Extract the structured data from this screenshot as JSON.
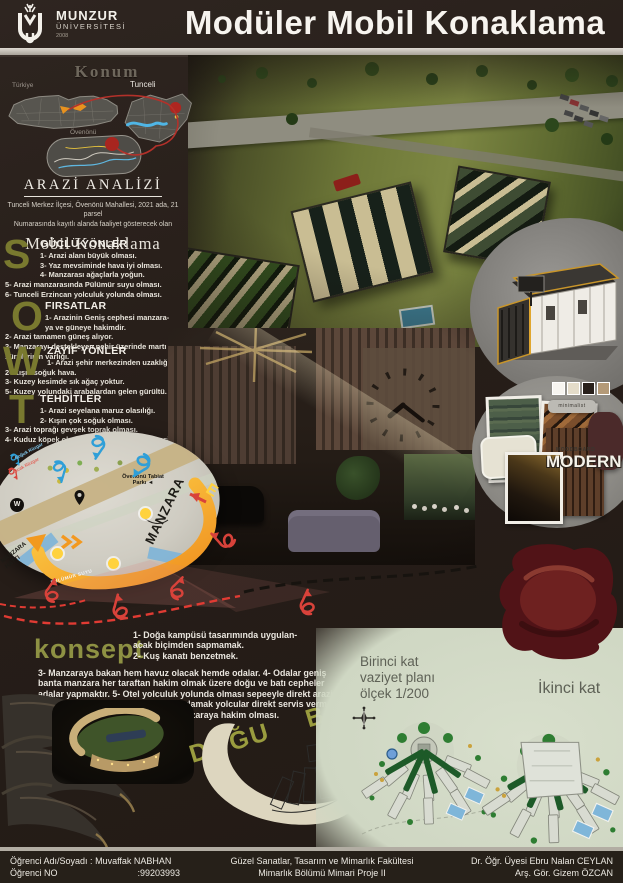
{
  "header": {
    "logo_name": "MUNZUR",
    "logo_sub": "ÜNİVERSİTESİ",
    "logo_year": "2008",
    "title": "Modüler Mobil Konaklama"
  },
  "location": {
    "title": "Konum",
    "turkey": "Türkiye",
    "tunceli": "Tunceli",
    "district": "Övenönü"
  },
  "arazi": {
    "title": "ARAZİ ANALİZİ",
    "intro": "Tunceli Merkez İlçesi, Övenönü Mahallesi, 2021 ada, 21 parsel\nNumarasında kayıtlı alanda faaliyet gösterecek olan",
    "subtitle": "Mobil Konaklama"
  },
  "swot": {
    "s": {
      "letter": "S",
      "heading": "GÜÇLÜ YÖNLER",
      "items": [
        "1- Arazi alanı büyük olması.",
        "3- Yaz mevsiminde hava iyi olması.",
        "4- Manzarası ağaçlarla yoğun.",
        "5- Arazi manzarasında Pülümür suyu olması.",
        "6- Tunceli Erzincan yolculuk yolunda olması."
      ]
    },
    "o": {
      "letter": "O",
      "heading": "FIRSATLAR",
      "items": [
        "1- Arazinin Geniş cephesi manzara-\nya ve güneye hakimdir.",
        "2- Arazi tamamen güneş alıyor.",
        "3- Manzarayı destekleyen nehir üzerinde martı sürülerinin varlığı."
      ]
    },
    "w": {
      "letter": "W",
      "heading": "ZAYIF YÖNLER",
      "items": [
        "1- Arazi şehir merkezinden uzaklığı.",
        "2- Kışın soğuk hava.",
        "3- Kuzey kesimde sık ağaç yoktur.",
        "5- Kuzey yolundaki arabalardan gelen gürültü."
      ]
    },
    "t": {
      "letter": "T",
      "heading": "TEHDİTLER",
      "items": [
        "1- Arazi seyelana maruz olasılığı.",
        "2- Kışın çok soğuk olması.",
        "3- Arazi toprağı gevşek toprak olması.",
        "4- Kuduz köpek olup olmadığı teyit edilmemesi."
      ]
    }
  },
  "diagram": {
    "park": "Övenönü Tabiat\nParkı ◄",
    "manzara": "MANZARA",
    "hatti": "MANZARA HATTI",
    "east": "E",
    "west": "W",
    "river": "PÜLÜMÜR SUYU",
    "legend_cold": "Soğuk Rüzgar",
    "legend_warm": "Sıcak Rüzgar"
  },
  "concept": {
    "title": "konsept",
    "top": "1- Doğa kampüsü tasarımında uygulan-\nacak biçimden sapmamak.\n2- Kuş kanatı benzetmek.",
    "body": "3- Manzaraya bakan hem havuz olacak hemde odalar. 4- Odalar geniş banta manzara her taraftan hakim olmak üzere doğu ve batı cepheler adalar yapmaktır. 5- Otel yolculuk yolunda olması sepeeyle direkt arazi yoldan en yakın kısımdan cafe tasarlamak yolcular direkt servis vermek arabadan inmeden. 6- Lobbynın manzaraya hakim olması."
  },
  "directions": {
    "east": "DOĞU",
    "west": "BATI"
  },
  "plans": {
    "first": "Birinci kat\nvaziyet planı\nölçek 1/200",
    "second": "İkinci kat"
  },
  "moodboard": {
    "tag": "minimalist",
    "board": "MOODBOARD",
    "style": "MODERN"
  },
  "footer": {
    "name_label": "Öğrenci Adı/Soyadı :",
    "name_value": "Muvaffak NABHAN",
    "no_label": "Öğrenci NO",
    "no_value": ":99203993",
    "faculty": "Güzel Sanatlar, Tasarım ve Mimarlık Fakültesi",
    "course": "Mimarlık Bölümü Mimari Proje II",
    "advisor1": "Dr. Öğr. Üyesi Ebru Nalan CEYLAN",
    "advisor2": "Arş. Gör. Gizem ÖZCAN"
  },
  "colors": {
    "accent_olive": "#8e9143",
    "arc_orange": "#f0921e",
    "wind_blue": "#2f9fd8",
    "alert_red": "#d8423a",
    "plan_bg": "#cfd7c3",
    "cream": "#ddd6bf"
  }
}
